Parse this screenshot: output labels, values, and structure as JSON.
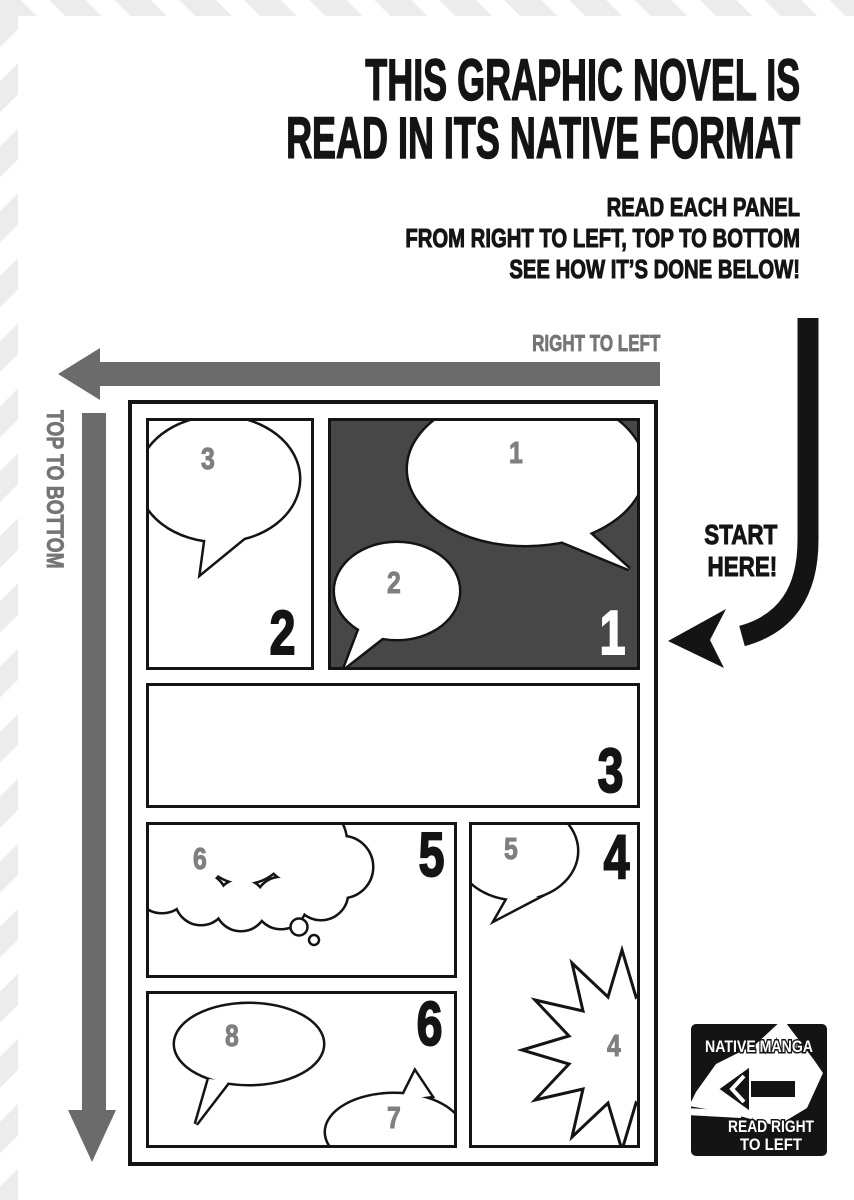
{
  "header": {
    "title_line1": "THIS GRAPHIC NOVEL IS",
    "title_line2": "READ IN ITS NATIVE FORMAT",
    "subtitle_line1": "READ EACH PANEL",
    "subtitle_line2": "FROM RIGHT TO LEFT, TOP TO BOTTOM",
    "subtitle_line3": "SEE HOW IT’S DONE BELOW!"
  },
  "labels": {
    "right_to_left": "RIGHT TO LEFT",
    "top_to_bottom": "TOP TO BOTTOM",
    "start_here_line1": "START",
    "start_here_line2": "HERE!"
  },
  "comic": {
    "panel1": {
      "number": "1",
      "bubble_a": "1",
      "bubble_b": "2"
    },
    "panel2": {
      "number": "2",
      "bubble_a": "3"
    },
    "panel3": {
      "number": "3"
    },
    "panel4": {
      "number": "4",
      "bubble_a": "5",
      "bubble_b": "4"
    },
    "panel5": {
      "number": "5",
      "bubble_a": "6"
    },
    "panel6": {
      "number": "6",
      "bubble_a": "8",
      "bubble_b": "7"
    }
  },
  "badge": {
    "line_top": "NATIVE MANGA",
    "line_bottom1": "READ RIGHT",
    "line_bottom2": "TO LEFT"
  },
  "colors": {
    "ink": "#141414",
    "dark_panel": "#474747",
    "arrow_gray": "#6b6b6b",
    "label_gray": "#757575",
    "bubble_number_gray": "#7f7f7f",
    "stripe_gray": "#ececec",
    "paper": "#ffffff"
  }
}
